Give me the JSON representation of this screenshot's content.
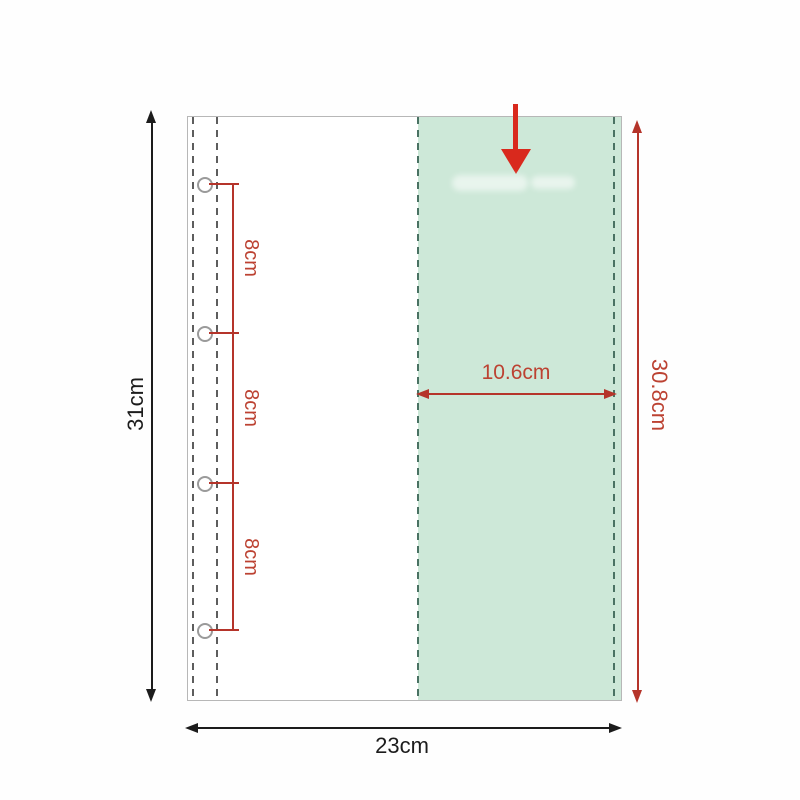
{
  "diagram": {
    "measurements": {
      "page_height": "31cm",
      "page_width": "23cm",
      "pocket_width": "10.6cm",
      "pocket_height": "30.8cm",
      "hole_spacing": [
        "8cm",
        "8cm",
        "8cm"
      ]
    },
    "colors": {
      "pocket_fill": "#cde8d8",
      "pocket_dash_green": "#4a7263",
      "page_dash_gray": "#5d5d5d",
      "page_border": "#b7b7b7",
      "dimension_red": "#b5342a",
      "label_red": "#bc4232",
      "insert_arrow_red": "#d9291d",
      "dimension_black": "#1c1c1c"
    },
    "icons": {
      "insert_arrow": "down-arrow-icon"
    }
  }
}
